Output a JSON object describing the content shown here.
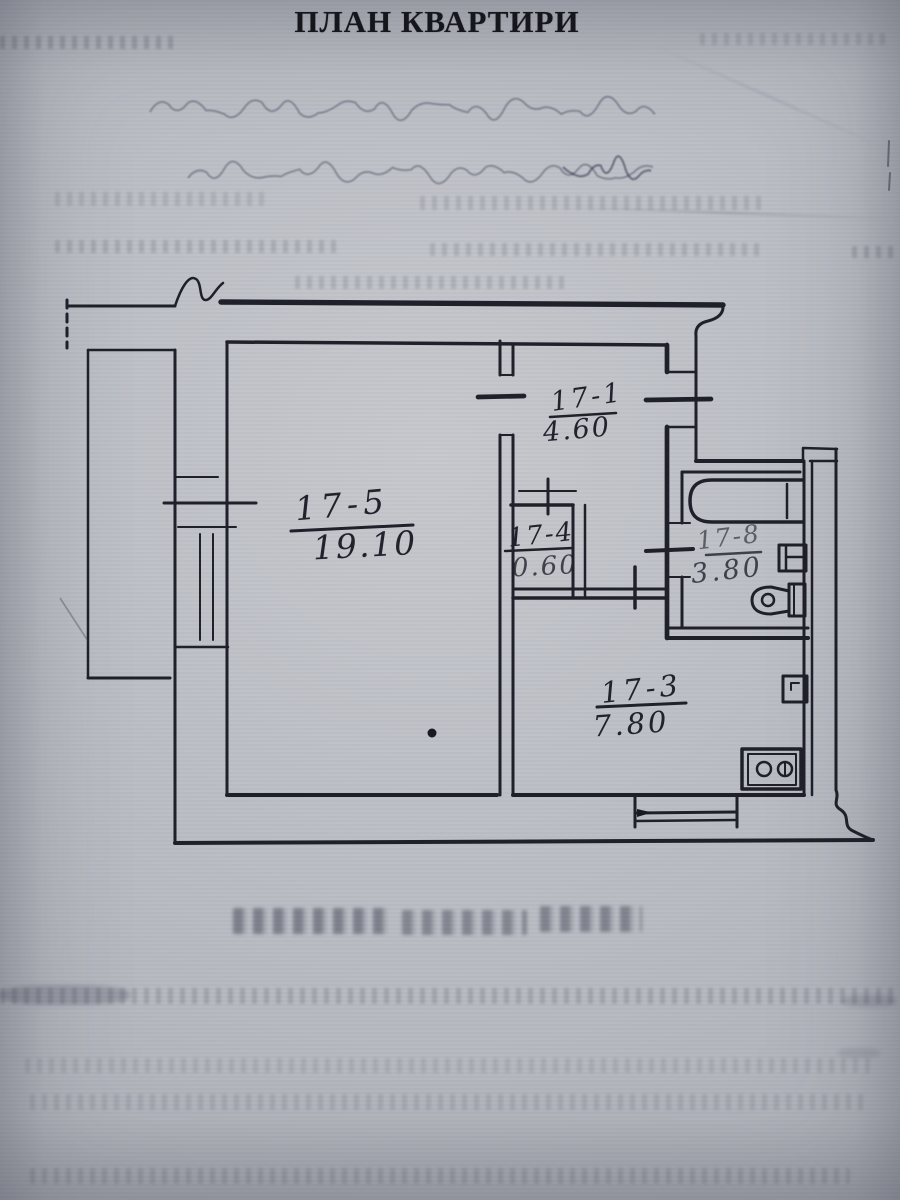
{
  "page": {
    "title": "ПЛАН КВАРТИРИ"
  },
  "floor_plan": {
    "rooms": [
      {
        "id": "17-5",
        "area": "19.10"
      },
      {
        "id": "17-1",
        "area": "4.60"
      },
      {
        "id": "17-4",
        "area": "0.60"
      },
      {
        "id": "17-8",
        "area": "3.80"
      },
      {
        "id": "17-3",
        "area": "7.80"
      }
    ],
    "fixtures": [
      "bathtub",
      "sink",
      "toilet",
      "stove",
      "vent-duct"
    ],
    "features": [
      "balcony",
      "balcony-door-and-window-block",
      "entry-door-opening",
      "interior-door-openings",
      "kitchen-window",
      "wall-break-symbol"
    ]
  },
  "scan_artifacts": {
    "handwriting": "faint illegible handwritten notes below title",
    "bleed_through": "faded mirrored print showing through from reverse side",
    "ink_dot": "small ink blot inside room 17-5"
  },
  "colors": {
    "paper": "#b9bcc3",
    "ink": "#20202a"
  }
}
